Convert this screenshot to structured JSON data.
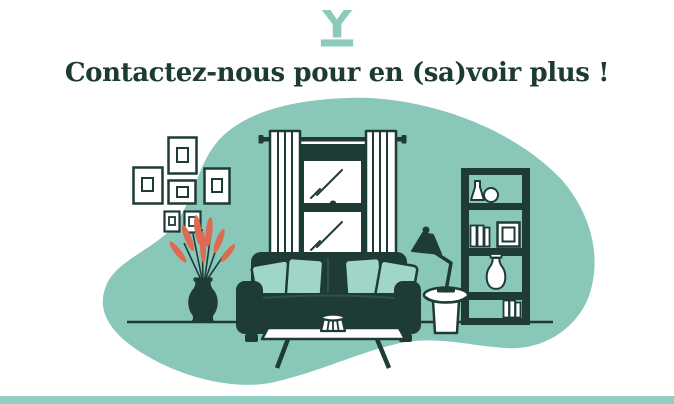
{
  "header": {
    "logo_icon": "y-monogram-logo",
    "title": "Contactez-nous pour en (sa)voir plus !"
  },
  "illustration": {
    "name": "living-room-illustration",
    "scene_items": [
      "background-blob",
      "picture-frames",
      "window-with-curtains",
      "plant-in-vase",
      "sofa-with-pillows",
      "coffee-table-with-pot",
      "side-table",
      "desk-lamp",
      "bookshelf-with-books-and-vases",
      "floor-line"
    ]
  },
  "footer": {
    "type": "accent-bar"
  },
  "colors": {
    "accent_teal": "#89C8B9",
    "accent_teal_light": "#9FD6C7",
    "dark_green": "#1E3B36",
    "coral": "#DD6B53",
    "footer_bar": "#93CEC3",
    "logo_teal": "#8CCBBC",
    "heading_text": "#1D3B33",
    "background": "#FFFFFF"
  }
}
